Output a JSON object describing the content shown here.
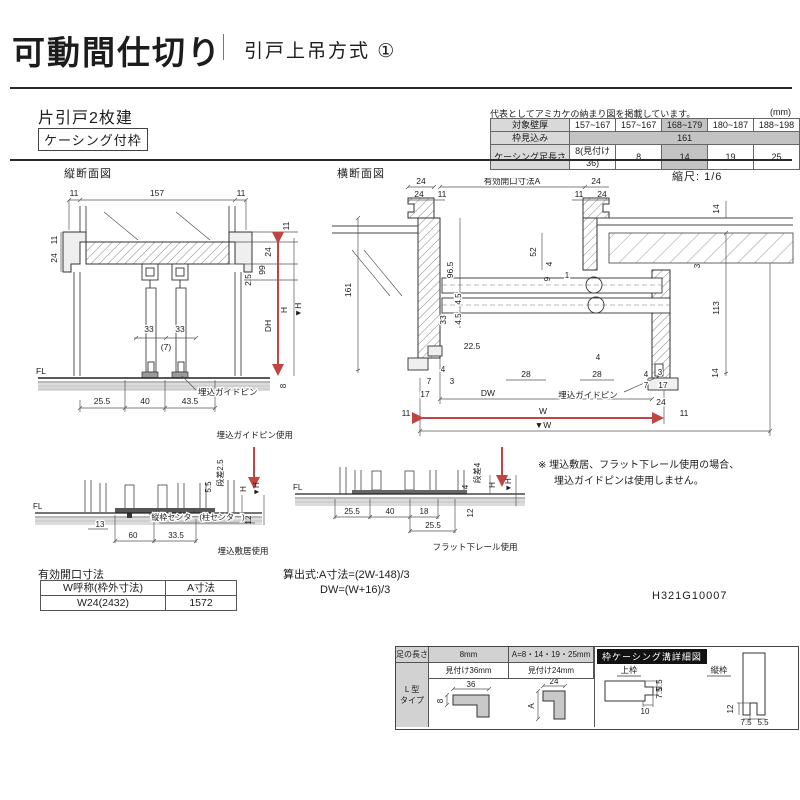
{
  "header": {
    "title": "可動間仕切り",
    "subtitle": "引戸上吊方式 ①"
  },
  "product": {
    "type_label": "片引戸2枚建",
    "frame_label": "ケーシング付枠"
  },
  "spec_table": {
    "note": "代表としてアミカケの納まり図を掲載しています。",
    "unit": "(mm)",
    "row1_label": "対象壁厚",
    "row1_values": [
      "157~167",
      "157~167",
      "168~179",
      "180~187",
      "188~198"
    ],
    "row2_label": "枠見込み",
    "row2_value": "161",
    "row3_label": "ケーシング足長さ",
    "row3_values": [
      "8(見付け36)",
      "8",
      "14",
      "19",
      "25"
    ]
  },
  "sections": {
    "vertical_title": "縦断面図",
    "horizontal_title": "横断面図",
    "scale": "縮尺: 1/6"
  },
  "vs": {
    "t11l": "11",
    "t157": "157",
    "t11r": "11",
    "l11": "11",
    "l24": "24",
    "r11": "11",
    "r24": "24",
    "r99": "99",
    "r25": "2.5",
    "m33a": "33",
    "m33b": "33",
    "m7": "(7)",
    "fl": "FL",
    "pin": "埋込ガイドピン",
    "b255": "25.5",
    "b40": "40",
    "b435": "43.5",
    "dh": "DH",
    "h": "H",
    "hv": "▼H",
    "b8": "8"
  },
  "hs": {
    "open_a": "有効開口寸法A",
    "c24a": "24",
    "c24b": "24",
    "c11a": "11",
    "r24a": "24",
    "r11a": "11",
    "r24b": "24",
    "r14a": "14",
    "l161": "161",
    "l965": "96.5",
    "l45a": "4.5",
    "l45b": "4.5",
    "l33": "33",
    "l225": "22.5",
    "m52": "52",
    "m4": "4",
    "m9": "9",
    "m1": "1",
    "r113": "113",
    "r3a": "3",
    "g4a": "4",
    "g28a": "28",
    "g28b": "28",
    "g4b": "4",
    "lb7": "7",
    "lb3": "3",
    "lb17": "17",
    "lb11": "11",
    "rb4": "4",
    "rb3": "3",
    "rb7": "7",
    "rb17": "17",
    "rb24": "24",
    "rb11": "11",
    "rb14": "14",
    "dw": "DW",
    "w": "W",
    "wv": "▼W",
    "pin": "埋込ガイドピン"
  },
  "d1": {
    "title": "埋込ガイドピン使用",
    "fl": "FL",
    "step": "段差2.5",
    "s55": "5.5",
    "h": "H",
    "hv": "▼H",
    "s12": "12",
    "s13": "13",
    "center": "縦枠センター(柱センター)",
    "s60": "60",
    "s335": "33.5",
    "caption": "埋込敷居使用"
  },
  "d2": {
    "fl": "FL",
    "step": "段差4",
    "s4": "4",
    "h": "H",
    "hv": "▼H",
    "s12": "12",
    "s255a": "25.5",
    "s40": "40",
    "s18": "18",
    "s255b": "25.5",
    "caption": "フラット下レール使用"
  },
  "note": {
    "line1": "※ 埋込敷居、フラット下レール使用の場合、",
    "line2": "埋込ガイドピンは使用しません。"
  },
  "opening_table": {
    "title": "有効開口寸法",
    "col1": "W呼称(枠外寸法)",
    "col2": "A寸法",
    "val1": "W24(2432)",
    "val2": "1572"
  },
  "formula": {
    "line1": "算出式:A寸法=(2W-148)/3",
    "line2": "DW=(W+16)/3"
  },
  "doc_number": "H321G10007",
  "leg_table": {
    "h1": "足の長さ",
    "h2": "8mm",
    "h3": "A=8・14・19・25mm",
    "detail_title": "枠ケーシング溝詳細図",
    "row_label_1": "L 型",
    "row_label_2": "タイプ",
    "sub2": "見付け36mm",
    "sub3": "見付け24mm",
    "dim36": "36",
    "dim8": "8",
    "dim24": "24",
    "dimA": "A",
    "upper_label": "上枠",
    "side_label": "縦枠",
    "u55": "5.5",
    "u75": "7.5",
    "u10": "10",
    "v12": "12",
    "v75": "7.5",
    "v55": "5.5"
  },
  "colors": {
    "accent_red": "#bf4545",
    "highlight_gray": "#c3c3c3",
    "header_black": "#121212"
  }
}
